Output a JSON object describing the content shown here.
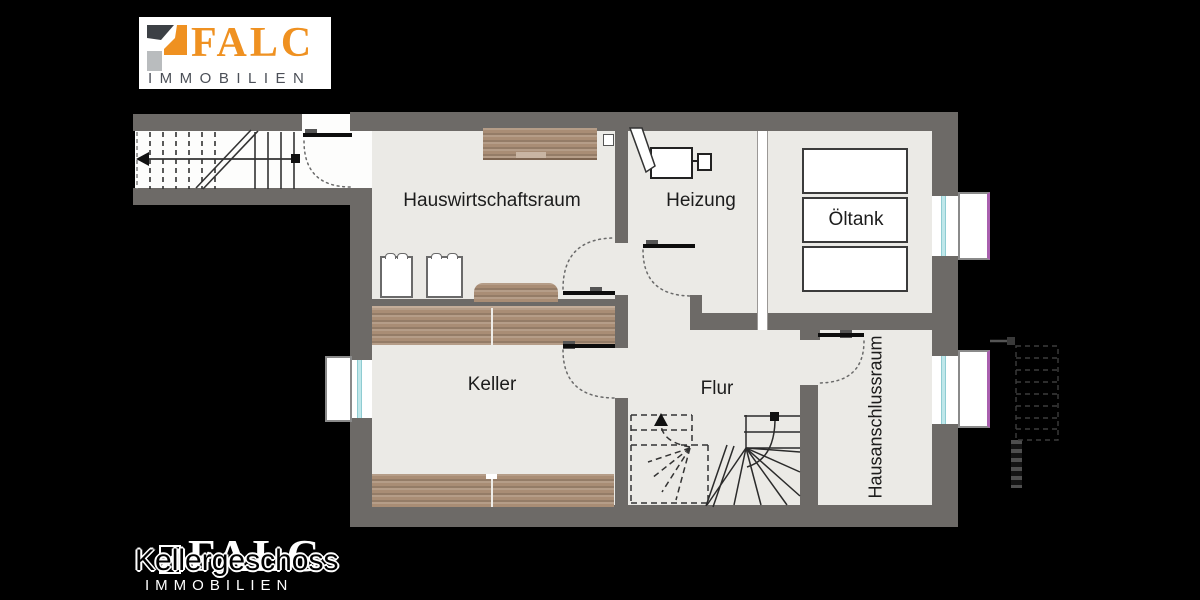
{
  "logo": {
    "brand": "FALC",
    "subtitle": "IMMOBILIEN"
  },
  "floor_plan": {
    "rooms": {
      "hauswirtschaftsraum": "Hauswirtschaftsraum",
      "heizung": "Heizung",
      "oeltank": "Öltank",
      "keller": "Keller",
      "flur": "Flur",
      "hausanschlussraum": "Hausanschlussraum"
    }
  },
  "footer": {
    "floor_label": "Kellergeschoss",
    "brand": "FALC",
    "subtitle": "IMMOBILIEN"
  },
  "colors": {
    "background": "#000000",
    "wall": "#6d6a67",
    "room_fill": "#ebeae6",
    "wood": "#a98d75",
    "brand_orange": "#ef9121",
    "window_glass": "#bfe7ea",
    "window_well_edge": "#a95fae"
  }
}
